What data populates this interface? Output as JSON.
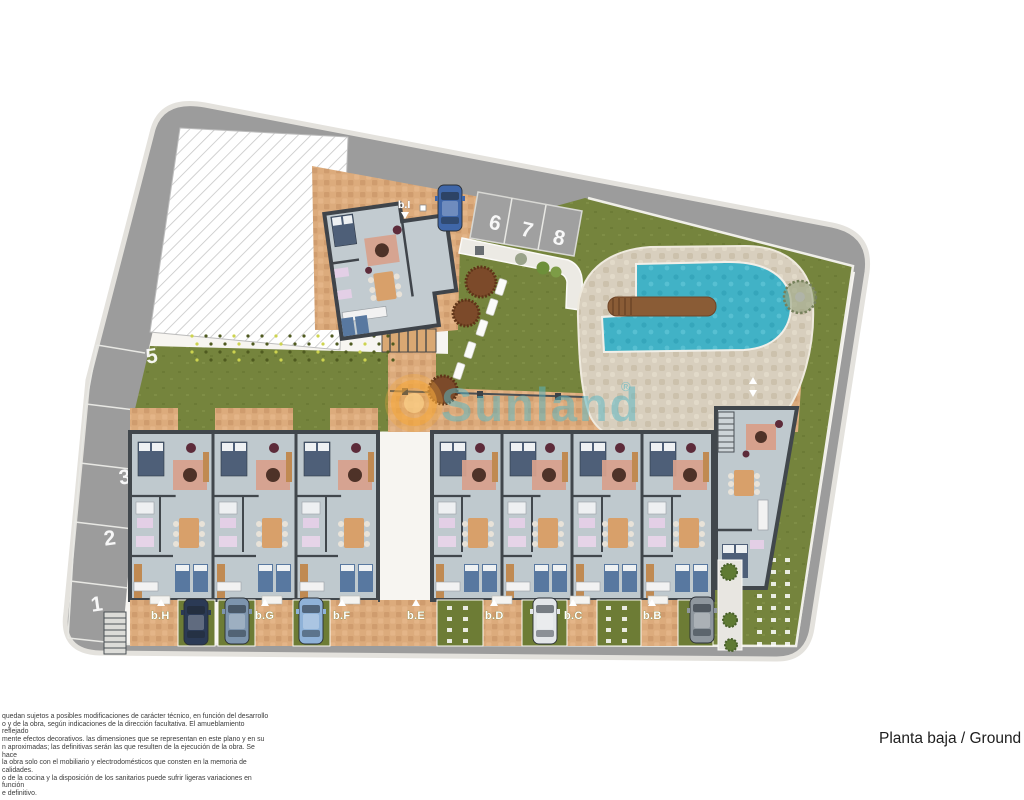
{
  "site": {
    "watermark": {
      "brand": "Sunland",
      "registered": "®"
    },
    "caption": {
      "text": "Planta baja / Ground f"
    },
    "disclaimer": {
      "lines": [
        "quedan sujetos a posibles modificaciones de carácter técnico, en función del desarrollo",
        "o y de la obra, según indicaciones de la dirección facultativa. El amueblamiento reflejado",
        "mente efectos decorativos. las dimensiones que se representan en este plano y en su",
        "n aproximadas; las definitivas serán las que resulten de la ejecución de la obra. Se hace",
        "la obra solo con el mobiliario y electrodomésticos que consten en la memoria de calidades.",
        "o de la cocina y la disposición de los sanitarios puede sufrir ligeras variaciones en función",
        "e definitivo."
      ]
    },
    "parking": {
      "left_numbers": [
        "5",
        "4",
        "3",
        "2",
        "1"
      ],
      "top_numbers": [
        "6",
        "7",
        "8"
      ]
    },
    "units": {
      "row_labels": [
        "b.H",
        "b.G",
        "b.F",
        "b.E",
        "b.D",
        "b.C",
        "b.B"
      ],
      "detached_label": "b.I"
    },
    "cars": [
      {
        "color": "#2b3a55"
      },
      {
        "color": "#7d94ad"
      },
      {
        "color": "#8fb2d8"
      },
      {
        "color": "#e3e6e9"
      },
      {
        "color": "#8f979e"
      },
      {
        "color": "#3f66a8"
      }
    ],
    "colors": {
      "road": "#9c9c9c",
      "lawn": "#75843d",
      "paving": "#dcab7c",
      "pool_water": "#41b2c6",
      "pool_deck": "#d8cfbe",
      "interior": "#bfc9ce",
      "wall": "#41474c",
      "watermark_teal": "#58b7c3",
      "watermark_orange": "#f6a83c"
    }
  }
}
